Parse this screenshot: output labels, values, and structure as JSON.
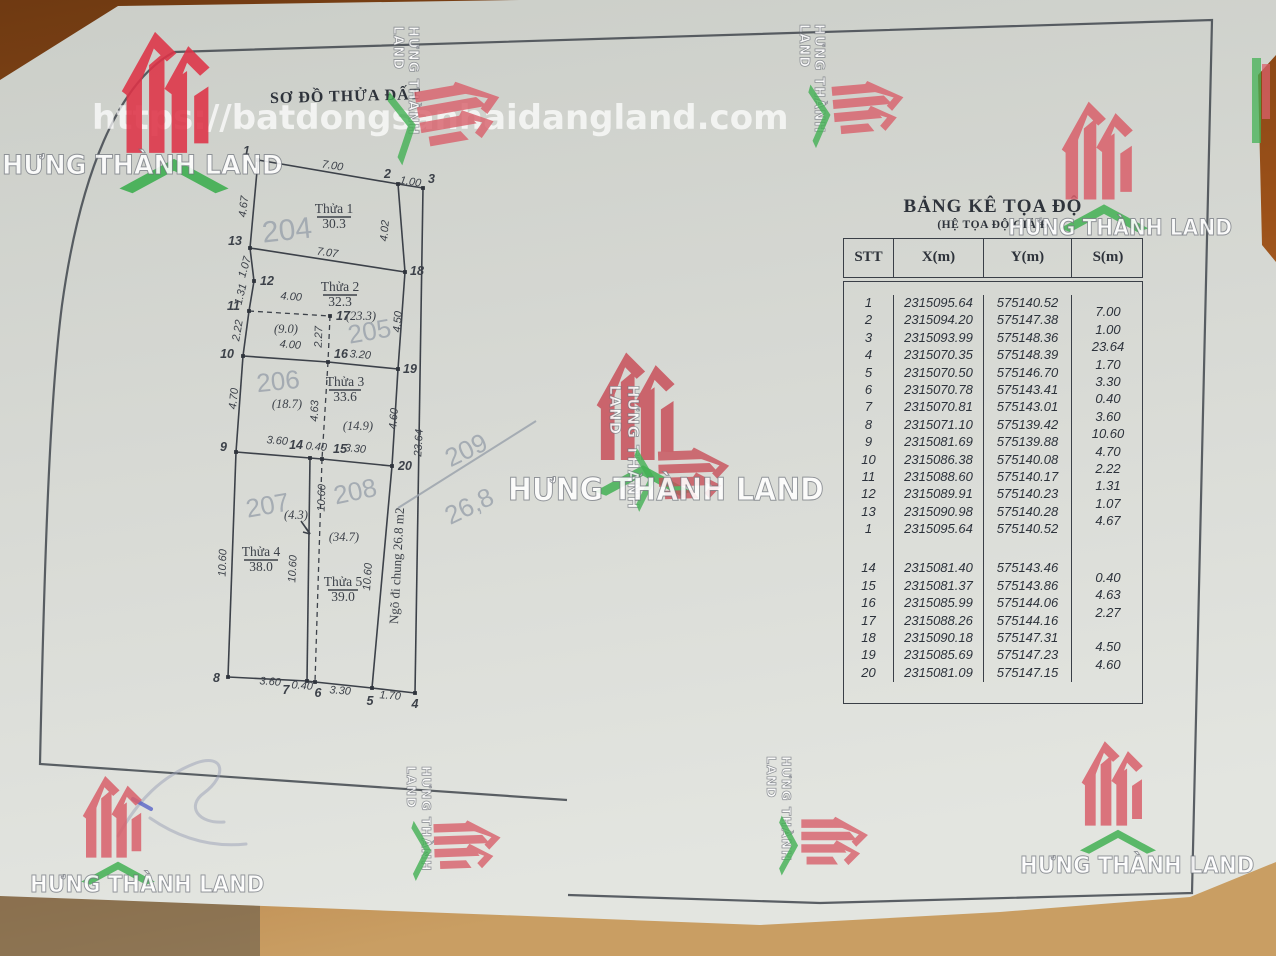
{
  "watermark": {
    "brand": "HƯNG THÀNH LAND",
    "url": "https://batdongsanhaidangland.com"
  },
  "colors": {
    "logo_red": "#d9606b",
    "logo_red_bright": "#de3347",
    "logo_green": "#43b154",
    "ink": "#3c4149",
    "pencil": "#99a1ab",
    "paper": "#d8dad5",
    "desk": "#a1561c"
  },
  "title": "SƠ ĐỒ THỬA ĐẤT",
  "coord_table": {
    "title": "BẢNG KÊ TỌA ĐỘ",
    "subtitle": "(HỆ TỌA ĐỘ GIẢ Đ",
    "headers": [
      "STT",
      "X(m)",
      "Y(m)",
      "S(m)"
    ],
    "rows1": [
      {
        "stt": "1",
        "x": "2315095.64",
        "y": "575140.52",
        "s": ""
      },
      {
        "stt": "2",
        "x": "2315094.20",
        "y": "575147.38",
        "s": "7.00"
      },
      {
        "stt": "3",
        "x": "2315093.99",
        "y": "575148.36",
        "s": "1.00"
      },
      {
        "stt": "4",
        "x": "2315070.35",
        "y": "575148.39",
        "s": "23.64"
      },
      {
        "stt": "5",
        "x": "2315070.50",
        "y": "575146.70",
        "s": "1.70"
      },
      {
        "stt": "6",
        "x": "2315070.78",
        "y": "575143.41",
        "s": "3.30"
      },
      {
        "stt": "7",
        "x": "2315070.81",
        "y": "575143.01",
        "s": "0.40"
      },
      {
        "stt": "8",
        "x": "2315071.10",
        "y": "575139.42",
        "s": "3.60"
      },
      {
        "stt": "9",
        "x": "2315081.69",
        "y": "575139.88",
        "s": "10.60"
      },
      {
        "stt": "10",
        "x": "2315086.38",
        "y": "575140.08",
        "s": "4.70"
      },
      {
        "stt": "11",
        "x": "2315088.60",
        "y": "575140.17",
        "s": "2.22"
      },
      {
        "stt": "12",
        "x": "2315089.91",
        "y": "575140.23",
        "s": "1.31"
      },
      {
        "stt": "13",
        "x": "2315090.98",
        "y": "575140.28",
        "s": "1.07"
      },
      {
        "stt": "1",
        "x": "2315095.64",
        "y": "575140.52",
        "s": "4.67"
      }
    ],
    "rows2": [
      {
        "stt": "14",
        "x": "2315081.40",
        "y": "575143.46",
        "s": ""
      },
      {
        "stt": "15",
        "x": "2315081.37",
        "y": "575143.86",
        "s": "0.40"
      },
      {
        "stt": "16",
        "x": "2315085.99",
        "y": "575144.06",
        "s": "4.63"
      },
      {
        "stt": "17",
        "x": "2315088.26",
        "y": "575144.16",
        "s": "2.27"
      },
      {
        "stt": "18",
        "x": "2315090.18",
        "y": "575147.31",
        "s": ""
      },
      {
        "stt": "19",
        "x": "2315085.69",
        "y": "575147.23",
        "s": "4.50"
      },
      {
        "stt": "20",
        "x": "2315081.09",
        "y": "575147.15",
        "s": "4.60"
      }
    ]
  },
  "diagram": {
    "solid": [
      [
        258,
        160,
        398,
        184
      ],
      [
        398,
        184,
        423,
        188
      ],
      [
        423,
        188,
        415,
        693
      ],
      [
        258,
        160,
        250,
        248
      ],
      [
        250,
        248,
        254,
        281
      ],
      [
        254,
        281,
        249,
        311
      ],
      [
        249,
        311,
        243,
        356
      ],
      [
        243,
        356,
        236,
        452
      ],
      [
        236,
        452,
        228,
        677
      ],
      [
        250,
        248,
        405,
        272
      ],
      [
        398,
        184,
        405,
        272
      ],
      [
        405,
        272,
        398,
        369
      ],
      [
        398,
        369,
        392,
        466
      ],
      [
        243,
        356,
        328,
        362
      ],
      [
        328,
        362,
        398,
        369
      ],
      [
        236,
        452,
        310,
        458
      ],
      [
        310,
        458,
        322,
        459
      ],
      [
        322,
        459,
        392,
        466
      ],
      [
        310,
        458,
        307,
        681
      ],
      [
        392,
        466,
        372,
        688
      ],
      [
        228,
        677,
        307,
        681
      ],
      [
        307,
        681,
        315,
        682
      ],
      [
        315,
        682,
        372,
        688
      ],
      [
        372,
        688,
        415,
        693
      ],
      [
        317,
        217,
        351,
        217
      ],
      [
        323,
        295,
        357,
        295
      ],
      [
        329,
        390,
        361,
        390
      ],
      [
        244,
        560,
        278,
        560
      ],
      [
        328,
        590,
        358,
        590
      ],
      [
        301,
        521,
        310,
        534
      ],
      [
        310,
        534,
        306,
        528
      ],
      [
        310,
        534,
        303,
        532
      ]
    ],
    "dashed": [
      [
        249,
        311,
        330,
        316
      ],
      [
        330,
        316,
        328,
        362
      ],
      [
        328,
        362,
        322,
        459
      ],
      [
        322,
        459,
        315,
        682
      ]
    ],
    "points": [
      {
        "n": "1",
        "x": 258,
        "y": 160,
        "lx": 250,
        "ly": 155,
        "a": "end"
      },
      {
        "n": "2",
        "x": 398,
        "y": 184,
        "lx": 391,
        "ly": 178,
        "a": "end"
      },
      {
        "n": "3",
        "x": 423,
        "y": 188,
        "lx": 428,
        "ly": 183,
        "a": "start"
      },
      {
        "n": "13",
        "x": 250,
        "y": 248,
        "lx": 242,
        "ly": 245,
        "a": "end"
      },
      {
        "n": "12",
        "x": 254,
        "y": 281,
        "lx": 260,
        "ly": 285,
        "a": "start"
      },
      {
        "n": "18",
        "x": 405,
        "y": 272,
        "lx": 410,
        "ly": 275,
        "a": "start"
      },
      {
        "n": "11",
        "x": 249,
        "y": 311,
        "lx": 240,
        "ly": 310,
        "a": "end"
      },
      {
        "n": "17",
        "x": 330,
        "y": 316,
        "lx": 336,
        "ly": 320,
        "a": "start"
      },
      {
        "n": "10",
        "x": 243,
        "y": 356,
        "lx": 234,
        "ly": 358,
        "a": "end"
      },
      {
        "n": "16",
        "x": 328,
        "y": 362,
        "lx": 334,
        "ly": 358,
        "a": "start"
      },
      {
        "n": "19",
        "x": 398,
        "y": 369,
        "lx": 403,
        "ly": 373,
        "a": "start"
      },
      {
        "n": "9",
        "x": 236,
        "y": 452,
        "lx": 227,
        "ly": 451,
        "a": "end"
      },
      {
        "n": "14",
        "x": 310,
        "y": 458,
        "lx": 303,
        "ly": 449,
        "a": "end"
      },
      {
        "n": "15",
        "x": 322,
        "y": 459,
        "lx": 333,
        "ly": 453,
        "a": "start"
      },
      {
        "n": "20",
        "x": 392,
        "y": 466,
        "lx": 398,
        "ly": 470,
        "a": "start"
      },
      {
        "n": "8",
        "x": 228,
        "y": 677,
        "lx": 220,
        "ly": 682,
        "a": "end"
      },
      {
        "n": "7",
        "x": 307,
        "y": 681,
        "lx": 286,
        "ly": 694,
        "a": "middle"
      },
      {
        "n": "6",
        "x": 315,
        "y": 682,
        "lx": 318,
        "ly": 697,
        "a": "middle"
      },
      {
        "n": "5",
        "x": 372,
        "y": 688,
        "lx": 370,
        "ly": 705,
        "a": "middle"
      },
      {
        "n": "4",
        "x": 415,
        "y": 693,
        "lx": 415,
        "ly": 708,
        "a": "middle"
      }
    ],
    "dims": [
      {
        "t": "7.00",
        "x": 332,
        "y": 169,
        "r": 9
      },
      {
        "t": "1.00",
        "x": 410,
        "y": 185,
        "r": 9
      },
      {
        "t": "7.07",
        "x": 327,
        "y": 256,
        "r": 8
      },
      {
        "t": "4.67",
        "x": 247,
        "y": 207,
        "r": -83
      },
      {
        "t": "1.07",
        "x": 248,
        "y": 268,
        "r": -74
      },
      {
        "t": "1.31",
        "x": 244,
        "y": 295,
        "r": -76
      },
      {
        "t": "2.22",
        "x": 241,
        "y": 331,
        "r": -80
      },
      {
        "t": "4.70",
        "x": 237,
        "y": 399,
        "r": -84
      },
      {
        "t": "10.60",
        "x": 226,
        "y": 563,
        "r": -88
      },
      {
        "t": "4.02",
        "x": 388,
        "y": 231,
        "r": -85
      },
      {
        "t": "4.50",
        "x": 401,
        "y": 322,
        "r": -85
      },
      {
        "t": "4.60",
        "x": 397,
        "y": 419,
        "r": -85
      },
      {
        "t": "23.64",
        "x": 422,
        "y": 443,
        "r": -87
      },
      {
        "t": "4.00",
        "x": 291,
        "y": 300,
        "r": 4
      },
      {
        "t": "4.00",
        "x": 290,
        "y": 348,
        "r": 5
      },
      {
        "t": "3.20",
        "x": 360,
        "y": 358,
        "r": 5
      },
      {
        "t": "2.27",
        "x": 322,
        "y": 337,
        "r": -88
      },
      {
        "t": "4.63",
        "x": 318,
        "y": 411,
        "r": -88
      },
      {
        "t": "3.60",
        "x": 277,
        "y": 444,
        "r": 5
      },
      {
        "t": "0.40",
        "x": 316,
        "y": 450,
        "r": 5
      },
      {
        "t": "3.30",
        "x": 355,
        "y": 452,
        "r": 5
      },
      {
        "t": "10.60",
        "x": 325,
        "y": 498,
        "r": -88
      },
      {
        "t": "10.60",
        "x": 296,
        "y": 569,
        "r": -87
      },
      {
        "t": "10.60",
        "x": 371,
        "y": 577,
        "r": -86
      },
      {
        "t": "3.60",
        "x": 270,
        "y": 685,
        "r": 4
      },
      {
        "t": "0.40",
        "x": 302,
        "y": 689,
        "r": 4
      },
      {
        "t": "3.30",
        "x": 340,
        "y": 694,
        "r": 4
      },
      {
        "t": "1.70",
        "x": 390,
        "y": 699,
        "r": 4
      }
    ],
    "plots": [
      {
        "name": "Thửa 1",
        "area": "30.3",
        "x": 334,
        "y": 213
      },
      {
        "name": "Thửa 2",
        "area": "32.3",
        "x": 340,
        "y": 291
      },
      {
        "name": "Thửa 3",
        "area": "33.6",
        "x": 345,
        "y": 386
      },
      {
        "name": "Thửa 4",
        "area": "38.0",
        "x": 261,
        "y": 556
      },
      {
        "name": "Thửa 5",
        "area": "39.0",
        "x": 343,
        "y": 586
      }
    ],
    "notes": [
      {
        "t": "(23.3)",
        "x": 361,
        "y": 320
      },
      {
        "t": "(9.0)",
        "x": 286,
        "y": 333
      },
      {
        "t": "(18.7)",
        "x": 287,
        "y": 408
      },
      {
        "t": "(14.9)",
        "x": 358,
        "y": 430
      },
      {
        "t": "(4.3)",
        "x": 296,
        "y": 519
      },
      {
        "t": "(34.7)",
        "x": 344,
        "y": 541
      }
    ],
    "alley": {
      "t": "Ngõ đi chung 26.8 m2",
      "x": 401,
      "y": 566,
      "r": -87
    },
    "hand": [
      {
        "t": "204",
        "x": 288,
        "y": 240,
        "s": 30,
        "r": -6
      },
      {
        "t": "205",
        "x": 371,
        "y": 340,
        "s": 26,
        "r": -10
      },
      {
        "t": "206",
        "x": 279,
        "y": 390,
        "s": 26,
        "r": -6
      },
      {
        "t": "207",
        "x": 269,
        "y": 514,
        "s": 26,
        "r": -10
      },
      {
        "t": "208",
        "x": 357,
        "y": 500,
        "s": 26,
        "r": -12
      },
      {
        "t": "209",
        "x": 470,
        "y": 458,
        "s": 26,
        "r": -26
      },
      {
        "t": "26,8",
        "x": 473,
        "y": 514,
        "s": 26,
        "r": -26
      }
    ],
    "hand_lines": [
      [
        398,
        508,
        536,
        421
      ]
    ]
  }
}
